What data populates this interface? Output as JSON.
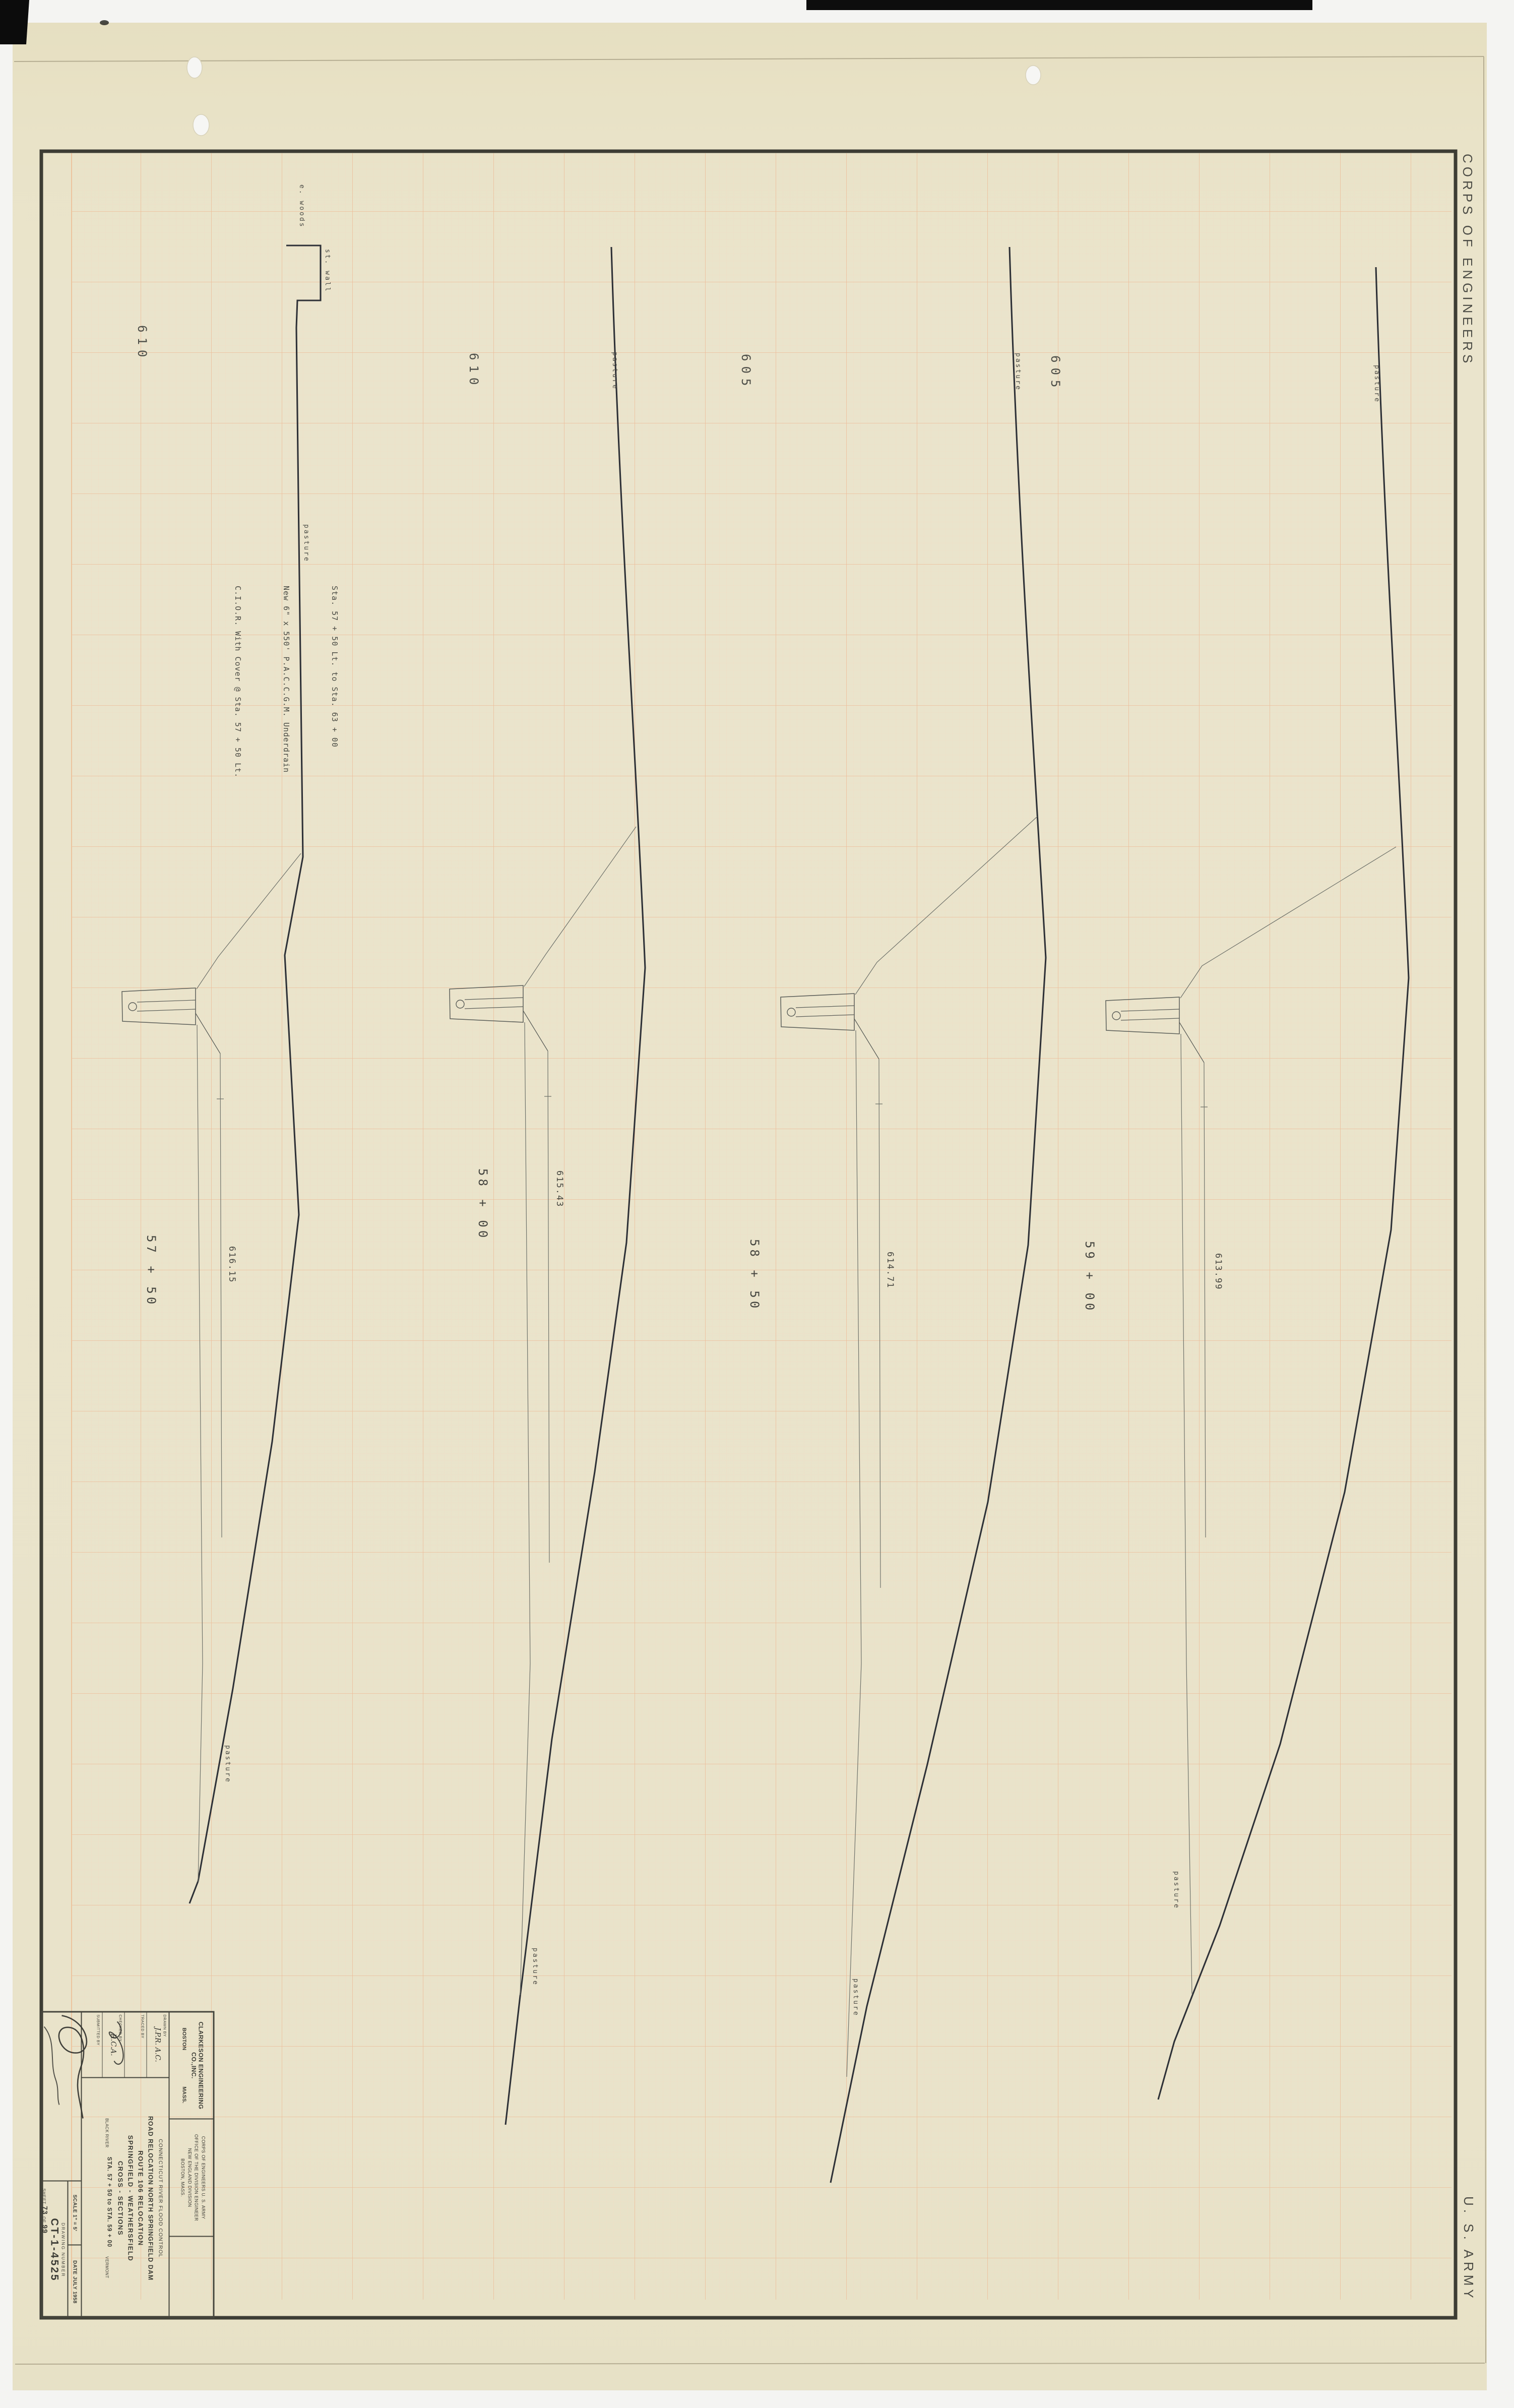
{
  "margin": {
    "corps_label": "CORPS OF ENGINEERS",
    "army_label": "U. S. ARMY"
  },
  "note": {
    "line1": "Sta. 57 + 50 Lt. to Sta. 63 + 00",
    "line2": "New 6\" x 550' P.A.C.C.G.M. Underdrain",
    "line3": "C.I.O.R. With Cover @ Sta. 57 + 50 Lt."
  },
  "grid_elevation_labels": [
    {
      "text": "610"
    },
    {
      "text": "610"
    },
    {
      "text": "605"
    },
    {
      "text": "605"
    }
  ],
  "sections": [
    {
      "station": "57 + 50",
      "centerline_elevation": "616.15",
      "upper_ground_label": "pasture",
      "lower_ground_label": "pasture",
      "woods_label": "e. woods",
      "wall_label": "st. wall"
    },
    {
      "station": "58 + 00",
      "centerline_elevation": "615.43",
      "upper_ground_label": "pasture",
      "lower_ground_label": "pasture"
    },
    {
      "station": "58 + 50",
      "centerline_elevation": "614.71",
      "upper_ground_label": "pasture",
      "lower_ground_label": "pasture"
    },
    {
      "station": "59 + 00",
      "centerline_elevation": "613.99",
      "upper_ground_label": "pasture",
      "lower_ground_label": "pasture"
    }
  ],
  "title_block": {
    "firm_name": "CLARKESON ENGINEERING CO.,INC.",
    "firm_city": "BOSTON",
    "firm_state": "MASS.",
    "agency_line1": "CORPS OF ENGINEERS   U. S. ARMY",
    "agency_line2": "OFFICE OF THE DIVISION ENGINEER",
    "agency_line3": "NEW ENGLAND DIVISION",
    "agency_line4": "BOSTON, MASS.",
    "drawn_by_label": "DRAWN BY",
    "drawn_by_value": "J.P.R.  A.C.",
    "traced_by_label": "TRACED BY",
    "traced_by_value": "",
    "checked_by_label": "CHECKED BY",
    "checked_by_value": "R.C.A.",
    "submitted_by_label": "SUBMITTED BY",
    "project_line1": "CONNECTICUT RIVER FLOOD CONTROL",
    "project_line2": "ROAD RELOCATION  NORTH SPRINGFIELD DAM",
    "title_line1": "ROUTE 106  RELOCATION",
    "title_line2": "SPRINGFIELD - WEATHERSFIELD",
    "title_line3": "CROSS - SECTIONS",
    "river_label": "BLACK RIVER",
    "station_range": "STA. 57 + 50  to  STA. 59 + 00",
    "state_label": "VERMONT",
    "scale_label": "SCALE 1\" = 5'",
    "date_label": "DATE JULY 1958",
    "drawing_number_label": "DRAWING NUMBER",
    "drawing_number": "CT-1-4525",
    "sheet_label": "SHEET",
    "sheet_number": "73",
    "sheet_of": "OF",
    "sheet_total": "99"
  },
  "colors": {
    "paper": "#eae4cc",
    "grid_major": "#eeb691",
    "grid_minor": "#f3d9c0",
    "border_ink": "#3d3d34",
    "ground_ink": "#2e3137",
    "accent_ink": "#45453f"
  }
}
